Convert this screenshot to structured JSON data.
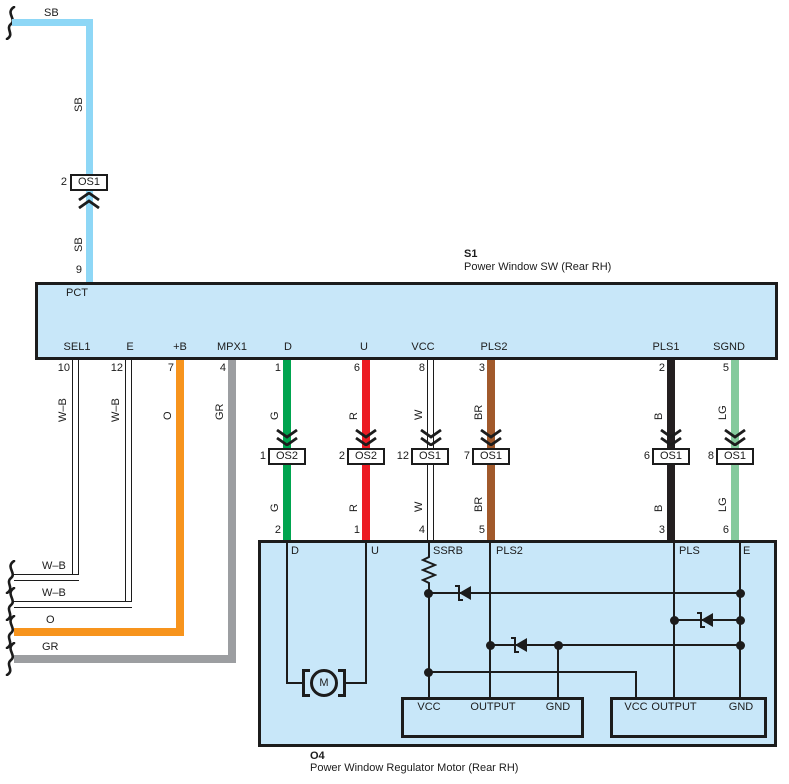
{
  "colors": {
    "sb_blue": "#8ED7F6",
    "component_fill": "#C8E7F9",
    "ink": "#1C1C1C",
    "green": "#00A44F",
    "red": "#EC1B23",
    "white_wire": "#FFFFFF",
    "brown": "#A1592B",
    "black_wire": "#231F20",
    "light_green": "#85CA9D",
    "orange": "#F7941D",
    "gray": "#9C9EA1"
  },
  "top": {
    "sb_horizontal_label": "SB",
    "sb_vertical_label_upper": "SB",
    "connector_pin": "2",
    "connector_name": "OS1",
    "sb_vertical_label_lower": "SB",
    "entry_pin": "9"
  },
  "s1": {
    "code": "S1",
    "name": "Power Window SW (Rear RH)",
    "internal_label": "PCT",
    "pins": [
      {
        "name": "SEL1",
        "number": "10"
      },
      {
        "name": "E",
        "number": "12"
      },
      {
        "name": "+B",
        "number": "7"
      },
      {
        "name": "MPX1",
        "number": "4"
      },
      {
        "name": "D",
        "number": "1"
      },
      {
        "name": "U",
        "number": "6"
      },
      {
        "name": "VCC",
        "number": "8"
      },
      {
        "name": "PLS2",
        "number": "3"
      },
      {
        "name": "PLS1",
        "number": "2"
      },
      {
        "name": "SGND",
        "number": "5"
      }
    ]
  },
  "left_wires": [
    {
      "color_code": "W–B",
      "tail_label": "W–B"
    },
    {
      "color_code": "W–B",
      "tail_label": "W–B"
    },
    {
      "color_code": "O",
      "tail_label": "O"
    },
    {
      "color_code": "GR",
      "tail_label": "GR"
    }
  ],
  "mid_wires": [
    {
      "upper_color": "G",
      "connector_pin": "1",
      "connector_name": "OS2",
      "lower_color": "G",
      "motor_pin": "2"
    },
    {
      "upper_color": "R",
      "connector_pin": "2",
      "connector_name": "OS2",
      "lower_color": "R",
      "motor_pin": "1"
    },
    {
      "upper_color": "W",
      "connector_pin": "12",
      "connector_name": "OS1",
      "lower_color": "W",
      "motor_pin": "4"
    },
    {
      "upper_color": "BR",
      "connector_pin": "7",
      "connector_name": "OS1",
      "lower_color": "BR",
      "motor_pin": "5"
    },
    {
      "upper_color": "B",
      "connector_pin": "6",
      "connector_name": "OS1",
      "lower_color": "B",
      "motor_pin": "3"
    },
    {
      "upper_color": "LG",
      "connector_pin": "8",
      "connector_name": "OS1",
      "lower_color": "LG",
      "motor_pin": "6"
    }
  ],
  "motor": {
    "code": "O4",
    "name": "Power Window Regulator Motor (Rear RH)",
    "terminals": {
      "d": "D",
      "u": "U",
      "ssrb": "SSRB",
      "pls2": "PLS2",
      "pls": "PLS",
      "e": "E"
    },
    "motor_symbol": "M",
    "driver1": {
      "vcc": "VCC",
      "output": "OUTPUT",
      "gnd": "GND"
    },
    "driver2": {
      "vcc": "VCC",
      "output": "OUTPUT",
      "gnd": "GND"
    }
  }
}
